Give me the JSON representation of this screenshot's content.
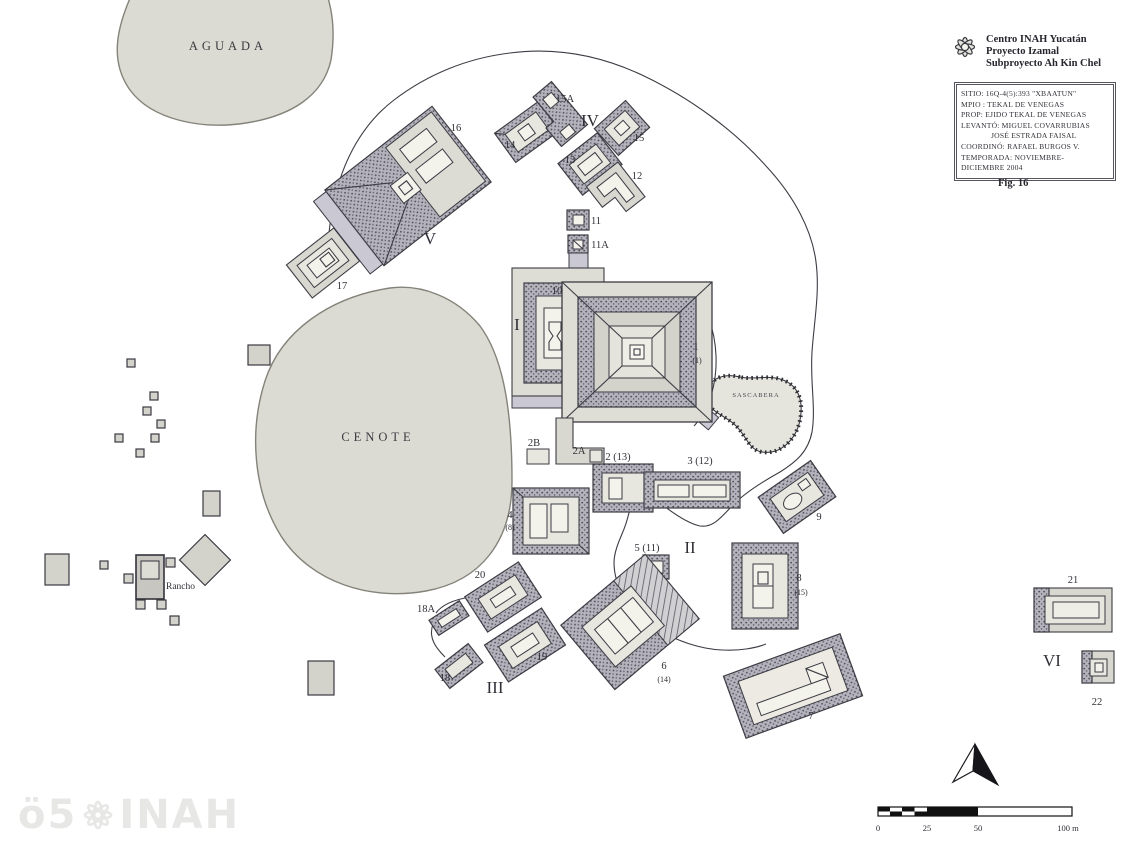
{
  "header": {
    "org_lines": [
      "Centro INAH Yucatán",
      "Proyecto Izamal",
      "Subproyecto Ah Kin Chel"
    ],
    "info_lines": [
      "SITIO: 16Q-4(5):393 \"XBAATUN\"",
      "MPIO : TEKAL DE VENEGAS",
      "PROP: EJIDO TEKAL DE VENEGAS",
      "LEVANTÓ: MIGUEL COVARRUBIAS",
      "JOSÉ ESTRADA FAISAL",
      "COORDINÓ: RAFAEL BURGOS V.",
      "TEMPORADA: NOVIEMBRE-",
      "DICIEMBRE 2004"
    ],
    "figure_label": "Fig. 16"
  },
  "map": {
    "area_labels": {
      "aguada": "AGUADA",
      "cenote": "CENOTE",
      "sascabera": "SASCABERA",
      "rancho": "Rancho"
    },
    "group_labels": {
      "g1": "I",
      "g2": "II",
      "g3": "III",
      "g4": "IV",
      "g5": "V",
      "g6": "VI"
    },
    "structure_labels": {
      "s16": "16",
      "s17": "17",
      "s14": "14",
      "s15A": "15A",
      "s15": "15",
      "s13": "13",
      "s12": "12",
      "s11": "11",
      "s11A": "11A",
      "s10": "10",
      "s1": "1",
      "s1sub": "(1)",
      "s2B": "2B",
      "s2A": "2A",
      "s2": "2 (13)",
      "s3": "3 (12)",
      "s9": "9",
      "s4": "4",
      "s4sub": "(8)",
      "s5": "5 (11)",
      "s8": "8",
      "s8sub": "(15)",
      "s6": "6",
      "s6sub": "(14)",
      "s20": "20",
      "s18A": "18A",
      "s19": "19",
      "s18": "18",
      "s7": "7",
      "s21": "21",
      "s22": "22"
    }
  },
  "scale_bar": {
    "ticks": {
      "t0": "0",
      "t25": "25",
      "t50": "50",
      "t100": "100 m"
    }
  },
  "watermark": {
    "left": "ö5",
    "right": "INAH"
  },
  "colors": {
    "paper": "#ffffff",
    "water_fill": "#dcdbd3",
    "ink": "#3c3c44",
    "stipple": "#b2b1ba",
    "skirt": "#c9c8d3"
  }
}
